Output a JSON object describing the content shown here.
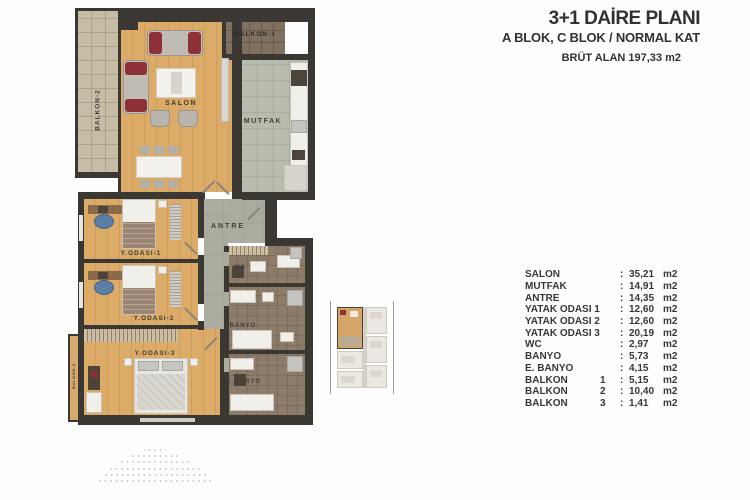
{
  "header": {
    "title": "3+1 DAİRE PLANI",
    "subtitle": "A BLOK, C BLOK / NORMAL KAT",
    "gross_area_label": "BRÜT ALAN",
    "gross_area_value": "197,33 m2"
  },
  "plan": {
    "labels": {
      "salon": "SALON",
      "mutfak": "MUTFAK",
      "antre": "ANTRE",
      "balkon1": "BALKON-1",
      "balkon2": "BALKON-2",
      "balkon3": "BALKON-3",
      "yatak1": "Y.ODASI-1",
      "yatak2": "Y.ODASI-2",
      "yatak3": "Y.ODASI-3",
      "wc": "WC",
      "banyo": "BANYO",
      "ebanyo": "E.BANYO"
    }
  },
  "area_table": {
    "separator": ":",
    "rows": [
      {
        "name": "SALON",
        "num": "",
        "value": "35,21",
        "unit": "m2"
      },
      {
        "name": "MUTFAK",
        "num": "",
        "value": "14,91",
        "unit": "m2"
      },
      {
        "name": "ANTRE",
        "num": "",
        "value": "14,35",
        "unit": "m2"
      },
      {
        "name": "YATAK ODASI 1",
        "num": "",
        "value": "12,60",
        "unit": "m2"
      },
      {
        "name": "YATAK ODASI 2",
        "num": "",
        "value": "12,60",
        "unit": "m2"
      },
      {
        "name": "YATAK ODASI 3",
        "num": "",
        "value": "20,19",
        "unit": "m2"
      },
      {
        "name": "WC",
        "num": "",
        "value": "2,97",
        "unit": "m2"
      },
      {
        "name": "BANYO",
        "num": "",
        "value": "5,73",
        "unit": "m2"
      },
      {
        "name": "E. BANYO",
        "num": "",
        "value": "4,15",
        "unit": "m2"
      },
      {
        "name": "BALKON",
        "num": "1",
        "value": "5,15",
        "unit": "m2"
      },
      {
        "name": "BALKON",
        "num": "2",
        "value": "10,40",
        "unit": "m2"
      },
      {
        "name": "BALKON",
        "num": "3",
        "value": "1,41",
        "unit": "m2"
      }
    ]
  },
  "colors": {
    "ink": "#33312d",
    "wall": "#3b3733",
    "wood": "#dcab68",
    "kitchen_tile": "#b8bcad",
    "bath_tile": "#8d7c6a",
    "balcony_tile": "#c7bca5",
    "antre_floor": "#a9ac9f",
    "accent_red": "#8e3136"
  }
}
